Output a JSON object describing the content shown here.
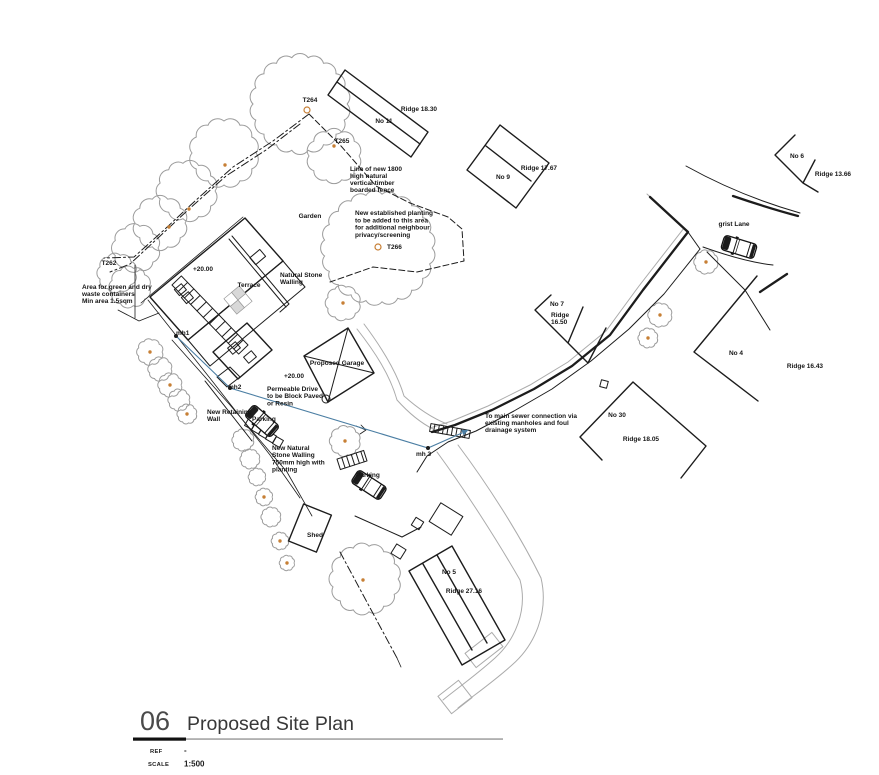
{
  "sheet": {
    "number": "06",
    "title": "Proposed Site Plan",
    "ref_label": "REF",
    "ref_value": "-",
    "scale_label": "SCALE",
    "scale_value": "1:500"
  },
  "colors": {
    "line": "#1c1c1c",
    "tree_gray": "#9c9c9c",
    "road_gray": "#ababab",
    "tree_marker_orange": "#c77f35",
    "drainage_blue": "#4b7ea3",
    "title_number_gray": "#4a4a4a",
    "title_text_gray": "#383838",
    "rule_gray": "#8f8f8f"
  },
  "plan": {
    "labels": [
      {
        "id": "t264",
        "text": "T264",
        "x": 310,
        "y": 102
      },
      {
        "id": "no-11",
        "text": "No 11",
        "x": 384,
        "y": 123
      },
      {
        "id": "ridge-18-30",
        "text": "Ridge 18.30",
        "x": 419,
        "y": 111
      },
      {
        "id": "t265",
        "text": "T265",
        "x": 342,
        "y": 143
      },
      {
        "id": "fence-note",
        "lines": [
          "Line of new 1800",
          "high natural",
          "vertical timber",
          "boarded fence"
        ],
        "x": 350,
        "y": 171,
        "anchor": "start",
        "lh": 7
      },
      {
        "id": "no-9",
        "text": "No 9",
        "x": 503,
        "y": 179
      },
      {
        "id": "ridge-17-67",
        "text": "Ridge 17.67",
        "x": 539,
        "y": 170
      },
      {
        "id": "no-6",
        "text": "No 6",
        "x": 797,
        "y": 158
      },
      {
        "id": "ridge-13-66",
        "text": "Ridge 13.66",
        "x": 833,
        "y": 176
      },
      {
        "id": "grist-lane",
        "text": "grist Lane",
        "x": 734,
        "y": 226
      },
      {
        "id": "garden",
        "text": "Garden",
        "x": 310,
        "y": 218
      },
      {
        "id": "planting-note",
        "lines": [
          "New established planting",
          "to be added to this area",
          "for additional neighbour",
          "privacy/screening"
        ],
        "x": 355,
        "y": 215,
        "anchor": "start",
        "lh": 7.3
      },
      {
        "id": "t266",
        "text": "T266",
        "x": 387,
        "y": 249,
        "anchor": "start"
      },
      {
        "id": "t262",
        "text": "T262",
        "x": 109,
        "y": 265
      },
      {
        "id": "level-20-house",
        "text": "+20.00",
        "x": 203,
        "y": 271
      },
      {
        "id": "terrace",
        "text": "Terrace",
        "x": 249,
        "y": 287
      },
      {
        "id": "stone-walling-note",
        "lines": [
          "Natural Stone",
          "Walling"
        ],
        "x": 280,
        "y": 277,
        "anchor": "start",
        "lh": 7
      },
      {
        "id": "waste-note",
        "lines": [
          "Area for green and dry",
          "waste containers",
          "Min area 1.5sqm"
        ],
        "x": 82,
        "y": 289,
        "anchor": "start",
        "lh": 7
      },
      {
        "id": "no-7",
        "text": "No 7",
        "x": 557,
        "y": 306
      },
      {
        "id": "ridge-16-50",
        "lines": [
          "Ridge",
          "16.50"
        ],
        "x": 551,
        "y": 317,
        "anchor": "start",
        "lh": 7
      },
      {
        "id": "no-4",
        "text": "No 4",
        "x": 736,
        "y": 355
      },
      {
        "id": "ridge-16-43",
        "text": "Ridge 16.43",
        "x": 805,
        "y": 368
      },
      {
        "id": "proposed-garage",
        "text": "Proposed Garage",
        "x": 337,
        "y": 365
      },
      {
        "id": "level-20-drive",
        "text": "+20.00",
        "x": 294,
        "y": 378
      },
      {
        "id": "mh2",
        "text": "mh2",
        "x": 228,
        "y": 389,
        "anchor": "start"
      },
      {
        "id": "permeable-note",
        "lines": [
          "Permeable Drive",
          "to be Block Paved",
          "or Resin"
        ],
        "x": 267,
        "y": 391,
        "anchor": "start",
        "lh": 7.2
      },
      {
        "id": "mh1",
        "text": "mh1",
        "x": 176,
        "y": 335,
        "anchor": "start"
      },
      {
        "id": "retaining-note",
        "lines": [
          "New Retaining",
          "Wall"
        ],
        "x": 207,
        "y": 414,
        "anchor": "start",
        "lh": 7
      },
      {
        "id": "stone-wall-note",
        "lines": [
          "New Natural",
          "Stone Walling",
          "750mm high with",
          "planting"
        ],
        "x": 272,
        "y": 450,
        "anchor": "start",
        "lh": 7.2
      },
      {
        "id": "mh3",
        "text": "mh 3",
        "x": 416,
        "y": 456,
        "anchor": "start"
      },
      {
        "id": "sewer-note",
        "lines": [
          "To main sewer connection via",
          "existing manholes and foul",
          "drainage system"
        ],
        "x": 485,
        "y": 418,
        "anchor": "start",
        "lh": 7
      },
      {
        "id": "no-30",
        "text": "No 30",
        "x": 617,
        "y": 417
      },
      {
        "id": "ridge-18-05",
        "text": "Ridge 18.05",
        "x": 641,
        "y": 441
      },
      {
        "id": "parking-1",
        "text": "Parking",
        "x": 252,
        "y": 421,
        "anchor": "start"
      },
      {
        "id": "parking-2",
        "text": "Parking",
        "x": 356,
        "y": 477,
        "anchor": "start"
      },
      {
        "id": "shed",
        "text": "Shed",
        "x": 315,
        "y": 537
      },
      {
        "id": "no-5",
        "text": "No 5",
        "x": 449,
        "y": 574
      },
      {
        "id": "ridge-27-16",
        "text": "Ridge 27.16",
        "x": 464,
        "y": 593
      }
    ]
  }
}
